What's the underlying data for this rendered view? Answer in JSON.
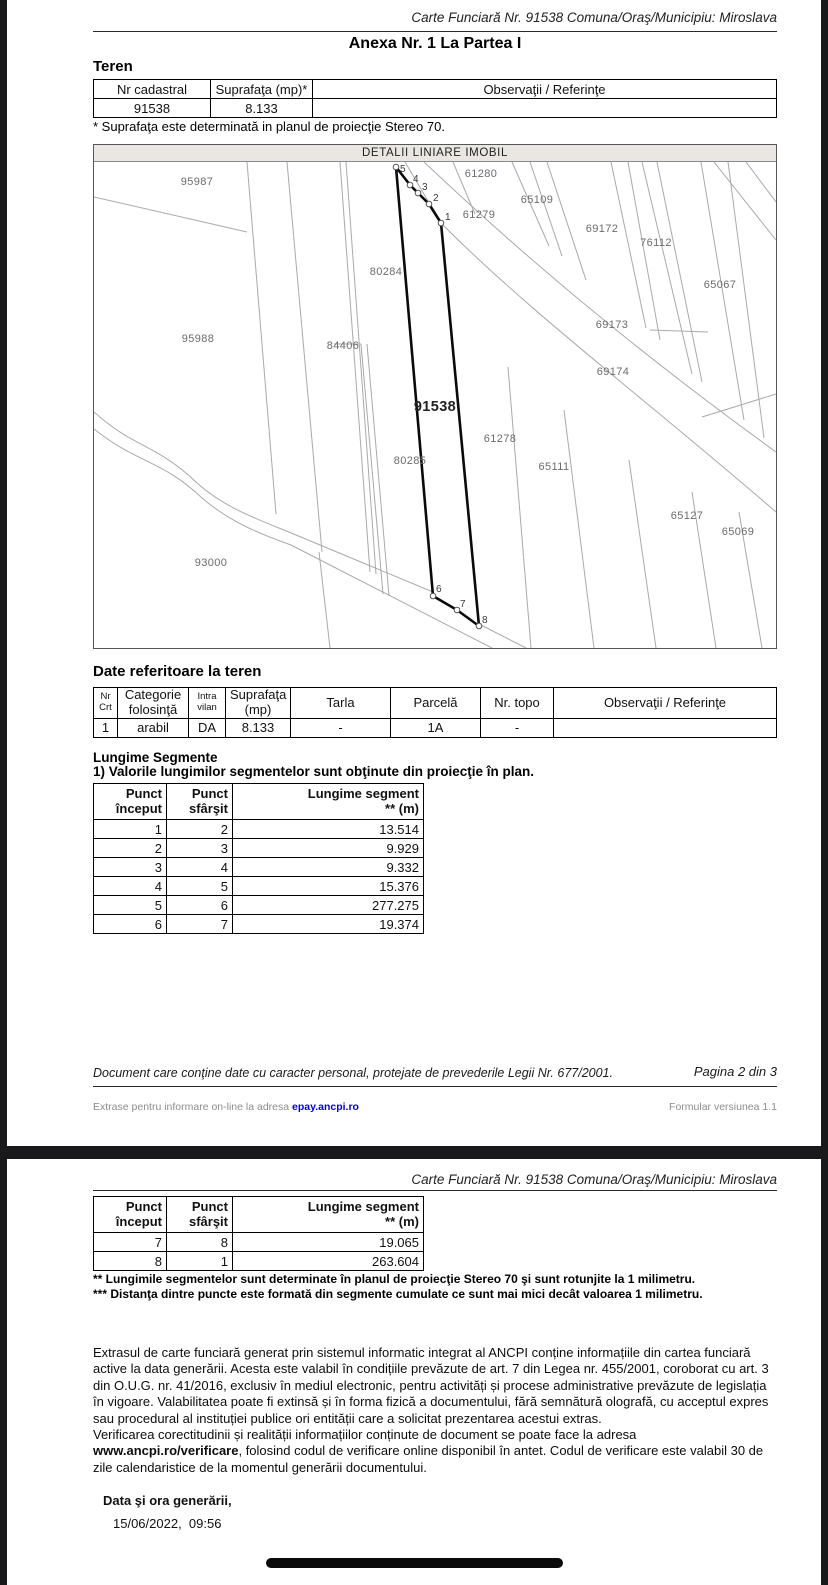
{
  "header": {
    "title": "Carte Funciară Nr. 91538 Comuna/Oraş/Municipiu: Miroslava"
  },
  "page2": {
    "annex_title": "Anexa Nr. 1 La Partea I",
    "teren_heading": "Teren",
    "teren_table": {
      "headers": [
        "Nr cadastral",
        "Suprafaţa (mp)*",
        "Observaţii / Referinţe"
      ],
      "row": [
        "91538",
        "8.133",
        ""
      ]
    },
    "teren_note": "* Suprafaţa este determinată in planul de proiecţie Stereo 70.",
    "map": {
      "title": "DETALII LINIARE IMOBIL",
      "parcels": [
        {
          "label": "95987"
        },
        {
          "label": "61280"
        },
        {
          "label": "65109"
        },
        {
          "label": "61279"
        },
        {
          "label": "69172"
        },
        {
          "label": "76112"
        },
        {
          "label": "65067"
        },
        {
          "label": "80284"
        },
        {
          "label": "69173"
        },
        {
          "label": "95988"
        },
        {
          "label": "84406"
        },
        {
          "label": "69174"
        },
        {
          "label": "91538"
        },
        {
          "label": "61278"
        },
        {
          "label": "80285"
        },
        {
          "label": "65111"
        },
        {
          "label": "65127"
        },
        {
          "label": "65069"
        },
        {
          "label": "93000"
        }
      ],
      "vertices": [
        {
          "label": "1"
        },
        {
          "label": "2"
        },
        {
          "label": "3"
        },
        {
          "label": "4"
        },
        {
          "label": "5"
        },
        {
          "label": "6"
        },
        {
          "label": "7"
        },
        {
          "label": "8"
        }
      ]
    },
    "date_heading": "Date referitoare la teren",
    "date_table": {
      "h1": [
        "Nr",
        "Categorie",
        "Intra",
        "Suprafaţa",
        "Tarla",
        "Parcelă",
        "Nr. topo",
        "Observaţii / Referinţe"
      ],
      "h2": [
        "Crt",
        "folosinţă",
        "vilan",
        "(mp)",
        "",
        "",
        "",
        ""
      ],
      "row": [
        "1",
        "arabil",
        "DA",
        "8.133",
        "-",
        "1A",
        "-",
        ""
      ]
    },
    "segments_heading": "Lungime Segmente",
    "segments_note": "1) Valorile lungimilor segmentelor sunt obţinute din proiecţie în plan.",
    "segments_table": {
      "col1_l1": "Punct",
      "col1_l2": "început",
      "col2_l1": "Punct",
      "col2_l2": "sfârşit",
      "col3_l1": "Lungime segment",
      "col3_l2": "** (m)",
      "rows": [
        [
          "1",
          "2",
          "13.514"
        ],
        [
          "2",
          "3",
          "9.929"
        ],
        [
          "3",
          "4",
          "9.332"
        ],
        [
          "4",
          "5",
          "15.376"
        ],
        [
          "5",
          "6",
          "277.275"
        ],
        [
          "6",
          "7",
          "19.374"
        ]
      ]
    },
    "footer": {
      "privacy": "Document care conţine date cu caracter personal, protejate de prevederile Legii Nr. 677/2001.",
      "page_info": "Pagina 2 din 3",
      "extract_prefix": "Extrase pentru informare on-line la adresa ",
      "extract_link": "epay.ancpi.ro",
      "form_version": "Formular versiunea 1.1"
    }
  },
  "page3": {
    "segments_table": {
      "col1_l1": "Punct",
      "col1_l2": "început",
      "col2_l1": "Punct",
      "col2_l2": "sfârşit",
      "col3_l1": "Lungime segment",
      "col3_l2": "** (m)",
      "rows": [
        [
          "7",
          "8",
          "19.065"
        ],
        [
          "8",
          "1",
          "263.604"
        ]
      ]
    },
    "footnote2": "** Lungimile segmentelor sunt determinate în planul de proiecţie Stereo 70 şi sunt rotunjite la 1 milimetru.",
    "footnote3": "*** Distanţa dintre puncte este formată din segmente cumulate ce sunt mai mici decât valoarea 1 milimetru.",
    "legal_para1": "Extrasul de carte funciară generat prin sistemul informatic integrat al ANCPI conține informațiile din cartea funciară active la data generării. Acesta este valabil în condițiile prevăzute de art. 7 din Legea nr. 455/2001, coroborat cu art. 3 din O.U.G. nr. 41/2016, exclusiv în mediul electronic, pentru activități și procese administrative prevăzute de legislația în vigoare. Valabilitatea poate fi extinsă și în forma fizică a documentului, fără semnătură olografă, cu acceptul expres sau procedural al instituției publice ori entității care a solicitat prezentarea acestui extras.",
    "legal_para2_prefix": "Verificarea corectitudinii și realității informațiilor conținute de document se poate face la adresa ",
    "legal_link": "www.ancpi.ro/verificare",
    "legal_para2_suffix": ", folosind codul de verificare online disponibil în antet. Codul de verificare este valabil 30 de zile calendaristice de la momentul generării documentului.",
    "generated_label": "Data şi ora generării,",
    "generated_value": "15/06/2022,  09:56"
  },
  "colors": {
    "background": "#19191c",
    "page": "#ffffff",
    "map_band": "#eae7e3",
    "map_lines": "#a9a9a9",
    "parcel_label": "#6b6b6b",
    "link_blue": "#0000e0"
  }
}
